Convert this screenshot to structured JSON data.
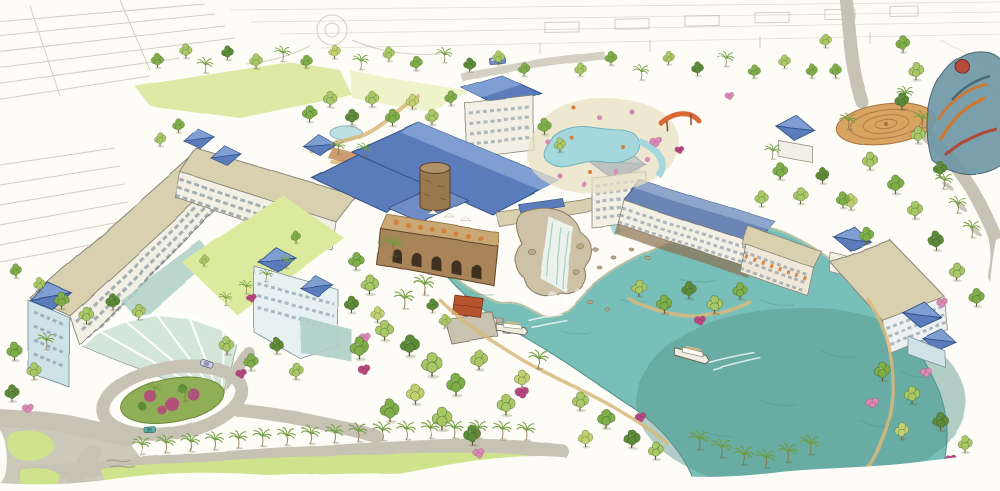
{
  "image": {
    "type": "watercolor architectural rendering",
    "subject": "Aerial watercolor rendering of a lakeside resort: hotel wings with blue pyramid roofs around a teal lagoon with waterfall, boat dock, water taxis, pool deck, gardens and palm-lined roads",
    "artist_signature": "illegible"
  },
  "palette": {
    "paper": "#fdfcf6",
    "sketch": "#a6a294",
    "lawn": "#cfe28c",
    "lawnBright": "#dcea9e",
    "fieldGreen": "#d9e79b",
    "treeLight": "#a9c765",
    "treeMid": "#7fae4a",
    "treeDark": "#5d8a39",
    "treeYellow": "#c3cf6f",
    "palm": "#6f9c3f",
    "water": "#79bfb9",
    "waterDeep": "#57948c",
    "pool": "#a5d8dc",
    "roofBlue": "#5a7cba",
    "roofBlueLight": "#7f9fd2",
    "roofBlueDark": "#2f4f86",
    "roofTan": "#d9d0b0",
    "wallWhite": "#f2efe4",
    "wallBlue": "#cfe2e8",
    "glass": "#aecfc6",
    "stone": "#9a7850",
    "stoneDark": "#5f4328",
    "rock": "#cdc2a8",
    "road": "#c6c2b4",
    "pathTan": "#d8b97c",
    "spiral": "#d8a462",
    "spiralDark": "#a8703c",
    "flowerPink": "#d98bb4",
    "flowerMagenta": "#b5487f",
    "orangeAccent": "#d2803c",
    "slideOrange": "#d96a35",
    "canopyGlass": "#cfe3d4",
    "boatWhite": "#efece0",
    "dockRed": "#b5552f",
    "terraceStone": "#a88458"
  },
  "scene": {
    "water_taxis": 2,
    "cars": 2,
    "landmarks": [
      "glass fan entry canopy",
      "flower roundabout island",
      "left hotel wings around courtyard lawn",
      "central lodge with round stone turret",
      "waterfall under bridge into lagoon",
      "boat dock with red roof",
      "pool deck with orange water slide",
      "spiral paved plaza",
      "colorful water-park structure on horizon",
      "palm-lined roads",
      "faint pencil-sketch background"
    ]
  }
}
